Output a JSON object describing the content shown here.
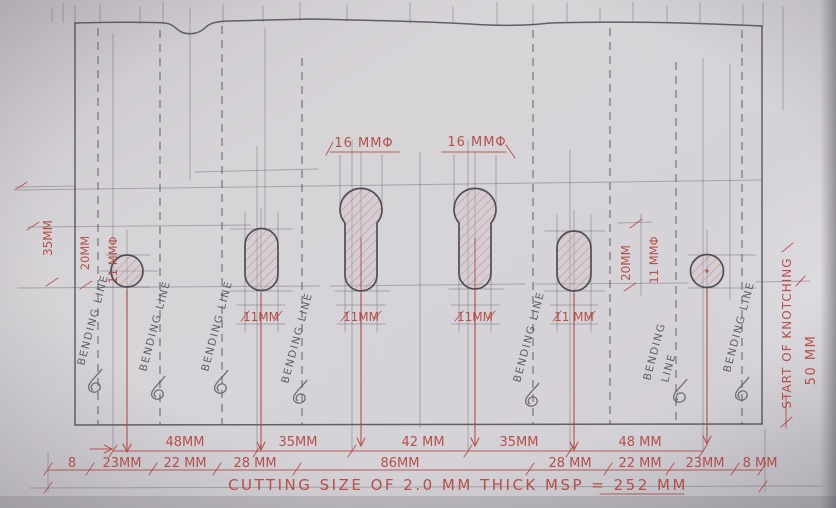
{
  "sheet": {
    "kind": "hand-drawn sheet metal layout drawing",
    "colors": {
      "paper": "#d5d2d7",
      "pencil": "#55535b",
      "red_ink": "#b2453e",
      "hatch": "#bd868b"
    }
  },
  "labels": {
    "bending_line": "BENDING LINE",
    "bending": "BENDING",
    "line": "LINE",
    "start_of_knotching": "START OF KNOTCHING",
    "knotch_offset": "50 MM"
  },
  "holes": {
    "key1_dia": "16 MMΦ",
    "key2_dia": "16 MMΦ",
    "slot1_w": "11MM",
    "key1_w": "11MM",
    "key2_w": "11MM",
    "slot2_w": "11 MM",
    "left_col": {
      "h35": "35MM",
      "h20": "20MM",
      "d11": "11 MMΦ"
    },
    "right_col": {
      "h20": "20MM",
      "d11": "11 MMΦ"
    }
  },
  "dims": {
    "row1": [
      "48MM",
      "35MM",
      "42 MM",
      "35MM",
      "48 MM"
    ],
    "row2": [
      "8",
      "23MM",
      "22 MM",
      "28 MM",
      "86MM",
      "28 MM",
      "22 MM",
      "23MM",
      "8 MM"
    ],
    "cutting_note": "CUTTING SIZE OF 2.0 MM THICK MSP = 252 MM"
  }
}
